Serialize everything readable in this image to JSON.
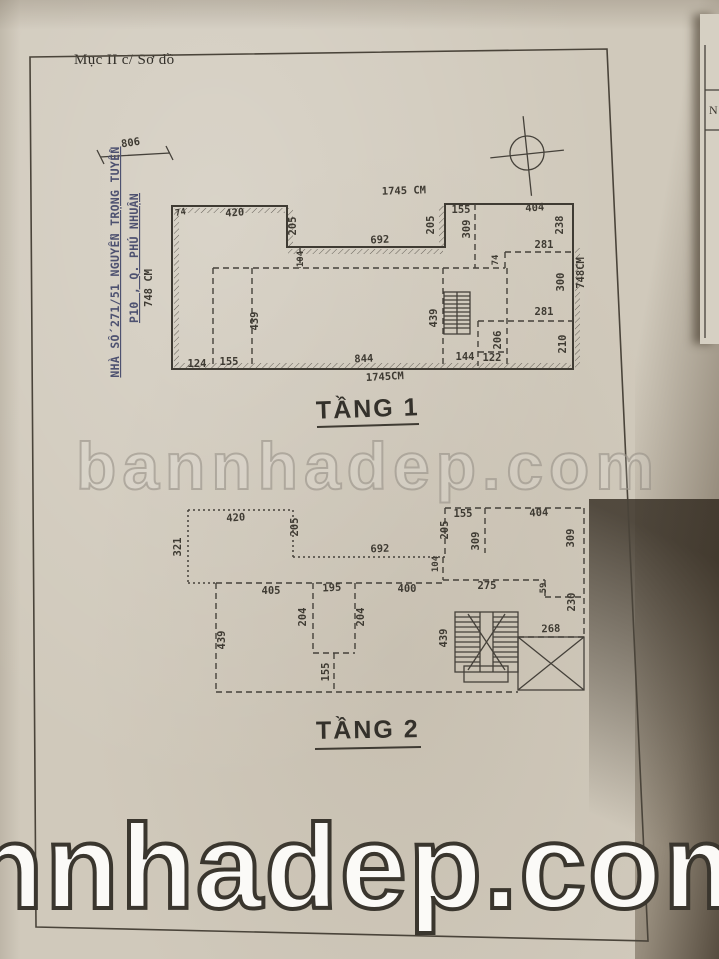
{
  "page": {
    "header": "Mục II c/ Sơ đồ",
    "side_note": {
      "line1": "NHÀ SỐ 271/51 NGUYỄN TRỌNG TUYỂN",
      "line2": "P10 , Q. PHÚ NHUẬN"
    },
    "adjacent_page_letter": "N",
    "colors": {
      "paper": "#d0c9bb",
      "ink": "#3f3b33",
      "blue_ink": "#4d5170",
      "shadow": "#52412c"
    }
  },
  "watermarks": {
    "middle": "bannhadep.com",
    "bottom": "nnhadep.com"
  },
  "floor1": {
    "title": "TẦNG 1",
    "labels": [
      {
        "t": "74",
        "x": 181,
        "y": 215,
        "r": -10,
        "s": 1
      },
      {
        "t": "420",
        "x": 235,
        "y": 216,
        "r": -4
      },
      {
        "t": "205",
        "x": 296,
        "y": 226,
        "r": -90
      },
      {
        "t": "692",
        "x": 380,
        "y": 243,
        "r": -3
      },
      {
        "t": "104",
        "x": 303,
        "y": 259,
        "r": -90,
        "s": 1
      },
      {
        "t": "205",
        "x": 434,
        "y": 225,
        "r": -90
      },
      {
        "t": "155",
        "x": 461,
        "y": 213,
        "r": 0
      },
      {
        "t": "309",
        "x": 470,
        "y": 229,
        "r": -90
      },
      {
        "t": "404",
        "x": 535,
        "y": 211,
        "r": -4
      },
      {
        "t": "238",
        "x": 563,
        "y": 225,
        "r": -90
      },
      {
        "t": "281",
        "x": 544,
        "y": 248,
        "r": 0
      },
      {
        "t": "74",
        "x": 498,
        "y": 260,
        "r": -90,
        "s": 1
      },
      {
        "t": "300",
        "x": 564,
        "y": 282,
        "r": -90
      },
      {
        "t": "439",
        "x": 258,
        "y": 321,
        "r": -90
      },
      {
        "t": "439",
        "x": 437,
        "y": 318,
        "r": -90
      },
      {
        "t": "206",
        "x": 501,
        "y": 340,
        "r": -90
      },
      {
        "t": "281",
        "x": 544,
        "y": 315,
        "r": 0
      },
      {
        "t": "210",
        "x": 566,
        "y": 344,
        "r": -90
      },
      {
        "t": "124",
        "x": 197,
        "y": 367,
        "r": 0
      },
      {
        "t": "155",
        "x": 229,
        "y": 365,
        "r": 0
      },
      {
        "t": "844",
        "x": 364,
        "y": 362,
        "r": -3
      },
      {
        "t": "144",
        "x": 465,
        "y": 360,
        "r": 0
      },
      {
        "t": "122",
        "x": 492,
        "y": 361,
        "r": 0
      },
      {
        "t": "1745 CM",
        "x": 404,
        "y": 194,
        "r": -2
      },
      {
        "t": "1745CM",
        "x": 385,
        "y": 380,
        "r": -3
      },
      {
        "t": "748 CM",
        "x": 152,
        "y": 288,
        "r": -90
      },
      {
        "t": "748CM",
        "x": 584,
        "y": 273,
        "r": -90
      },
      {
        "t": "806",
        "x": 131,
        "y": 146,
        "r": -8
      }
    ]
  },
  "floor2": {
    "title": "TẦNG 2",
    "labels": [
      {
        "t": "420",
        "x": 236,
        "y": 521,
        "r": -4
      },
      {
        "t": "321",
        "x": 181,
        "y": 547,
        "r": -90
      },
      {
        "t": "205",
        "x": 298,
        "y": 527,
        "r": -90
      },
      {
        "t": "692",
        "x": 380,
        "y": 552,
        "r": -2
      },
      {
        "t": "104",
        "x": 438,
        "y": 564,
        "r": -90,
        "s": 1
      },
      {
        "t": "155",
        "x": 463,
        "y": 517,
        "r": 0
      },
      {
        "t": "205",
        "x": 448,
        "y": 530,
        "r": -90
      },
      {
        "t": "309",
        "x": 479,
        "y": 541,
        "r": -90
      },
      {
        "t": "404",
        "x": 539,
        "y": 516,
        "r": -3
      },
      {
        "t": "309",
        "x": 574,
        "y": 538,
        "r": -90
      },
      {
        "t": "275",
        "x": 487,
        "y": 589,
        "r": 0
      },
      {
        "t": "59",
        "x": 546,
        "y": 588,
        "r": -90,
        "s": 1
      },
      {
        "t": "230",
        "x": 575,
        "y": 602,
        "r": -90
      },
      {
        "t": "405",
        "x": 271,
        "y": 594,
        "r": 0
      },
      {
        "t": "195",
        "x": 332,
        "y": 591,
        "r": -3
      },
      {
        "t": "400",
        "x": 407,
        "y": 592,
        "r": 0
      },
      {
        "t": "204",
        "x": 306,
        "y": 617,
        "r": -90
      },
      {
        "t": "204",
        "x": 364,
        "y": 617,
        "r": -90
      },
      {
        "t": "439",
        "x": 225,
        "y": 640,
        "r": -90
      },
      {
        "t": "439",
        "x": 447,
        "y": 638,
        "r": -90
      },
      {
        "t": "155",
        "x": 329,
        "y": 672,
        "r": -90
      },
      {
        "t": "268",
        "x": 551,
        "y": 632,
        "r": -2
      }
    ]
  }
}
